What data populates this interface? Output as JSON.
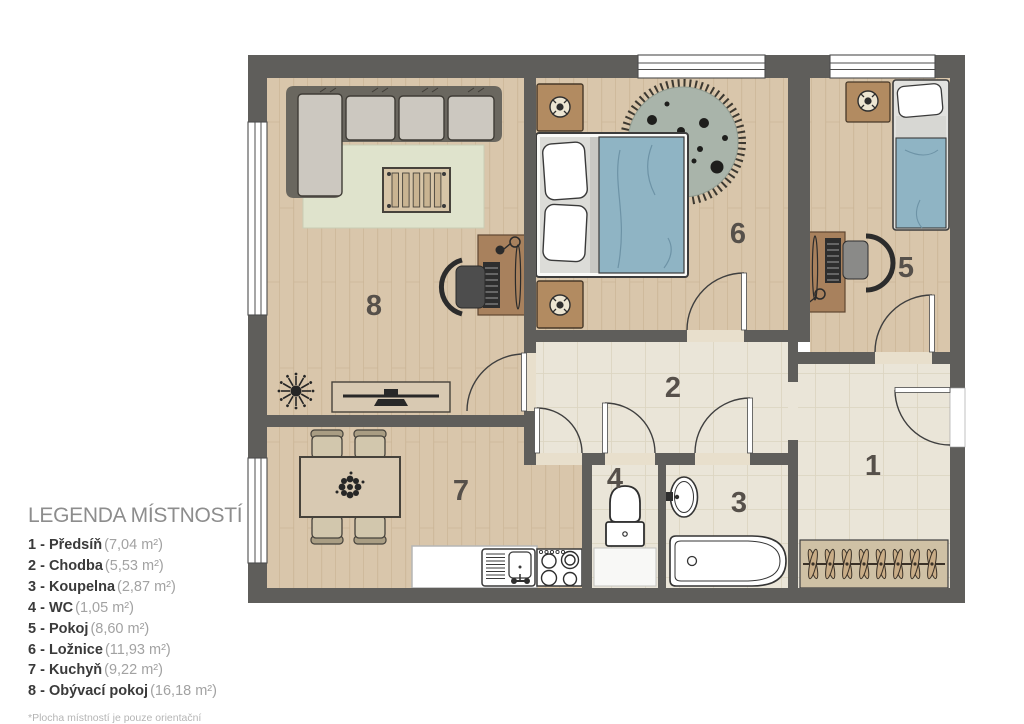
{
  "legend": {
    "title": "LEGENDA MÍSTNOSTÍ",
    "items": [
      {
        "label": "1 - Předsíň",
        "area": "(7,04 m²)"
      },
      {
        "label": "2 - Chodba",
        "area": "(5,53 m²)"
      },
      {
        "label": "3 - Koupelna",
        "area": "(2,87 m²)"
      },
      {
        "label": "4 - WC",
        "area": "(1,05 m²)"
      },
      {
        "label": "5 - Pokoj",
        "area": "(8,60 m²)"
      },
      {
        "label": "6 - Ložnice",
        "area": "(11,93 m²)"
      },
      {
        "label": "7 - Kuchyň",
        "area": "(9,22 m²)"
      },
      {
        "label": "8 - Obývací pokoj",
        "area": "(16,18 m²)"
      }
    ],
    "footnote": "*Plocha místností je pouze orientační"
  },
  "floorplan": {
    "room_numbers": {
      "hall": "1",
      "corridor": "2",
      "bathroom": "3",
      "wc": "4",
      "room": "5",
      "bedroom": "6",
      "kitchen": "7",
      "living_room": "8"
    },
    "colors": {
      "wall": "#5f5e5b",
      "wood_floor": "#d9c6ab",
      "tile_floor": "#eae5d8",
      "rug_living": "#dfe3cc",
      "rug_round": "#a9b4aa",
      "bed_blue": "#8fb4c4",
      "furniture_wood": "#a8815d",
      "furniture_tan": "#d8c9b2",
      "sofa_gray": "#ccc8c0",
      "label": "#56504a"
    }
  }
}
